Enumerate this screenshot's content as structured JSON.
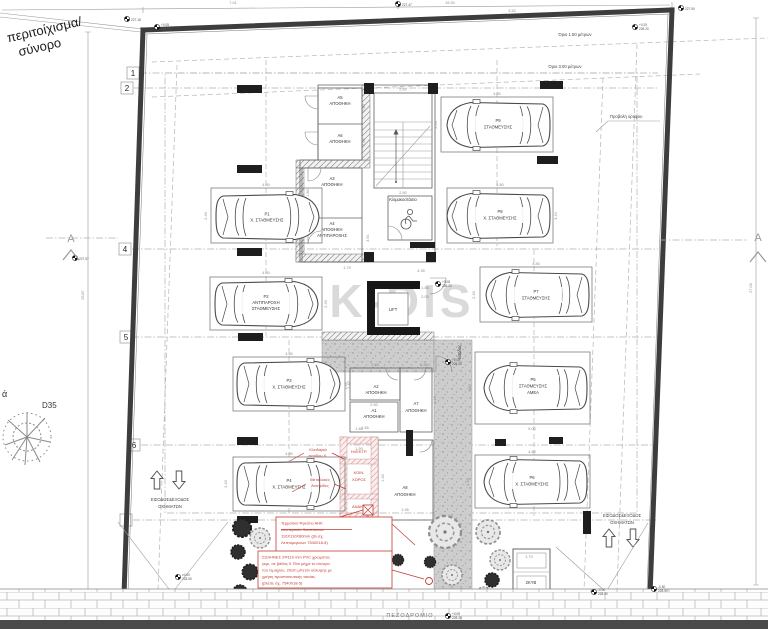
{
  "site": {
    "boundary_label": [
      "περιτοίχισμα/",
      "σύνορο"
    ],
    "tree_tag": "ά",
    "tree_id": "D35",
    "sidewalk": "ΠΕΖΟΔΡΟΜΙΟ",
    "setback_150": "Όριο 1.50 μέτρων",
    "setback_300": "Όριο 3.00 μέτρων",
    "projection": "Προβολή ορόφου",
    "entry_left": [
      "ΕΙΣΟΔΟΣ&ΕΞΟΔΟΣ",
      "ΟΧΗΜΑΤΩΝ"
    ],
    "entry_right": [
      "ΕΙΣΟΔΟΣ&ΕΞΟΔΟΣ",
      "ΟΧΗΜΑΤΩΝ"
    ],
    "section": "A",
    "watermark": "K-DIS",
    "bins": "2ΚΥΒ"
  },
  "grid": [
    "1",
    "2",
    "4",
    "5",
    "6",
    "7"
  ],
  "core": {
    "stair": "Κλιμακοστάσιο",
    "lift": "LIFT",
    "entrance": "είσοδος"
  },
  "storage": {
    "a1": [
      "A1",
      "ΑΠΟΘΗΚΗ"
    ],
    "a2": [
      "A2",
      "ΑΠΟΘΗΚΗ"
    ],
    "a3": [
      "A3",
      "ΑΠΟΘΗΚΗ"
    ],
    "a4": [
      "A4",
      "ΑΠΟΘΗΚΗ",
      "ΑΝΤΙΠΑΡΟΧΗΣ"
    ],
    "a5": [
      "A5",
      "ΑΠΟΘΗΚΗ"
    ],
    "a6": [
      "A6",
      "ΑΠΟΘΗΚΗ"
    ],
    "a7": [
      "A7",
      "ΑΠΟΘΗΚΗ"
    ],
    "a8": [
      "A8",
      "ΑΠΟΘΗΚΗ"
    ]
  },
  "parking": {
    "p1": [
      "P1",
      "Χ. ΣΤΑΘΜΕΥΣΗΣ"
    ],
    "p2": [
      "P2",
      "ΑΝΤΙΠΑΡΟΧΗ",
      "ΣΤΑΘΜΕΥΣΗΣ"
    ],
    "p3": [
      "P3",
      "Χ. ΣΤΑΘΜΕΥΣΗΣ"
    ],
    "p4": [
      "P4",
      "Χ. ΣΤΑΘΜΕΥΣΗΣ"
    ],
    "p5": [
      "P5",
      "ΣΤΑΘΜΕΥΣΗΣ",
      "ΑΜΕΑ"
    ],
    "p6": [
      "P6",
      "Χ. ΣΤΑΘΜΕΥΣΗΣ"
    ],
    "p7": [
      "P7",
      "ΣΤΑΘΜΕΥΣΗΣ"
    ],
    "p8": [
      "P8",
      "Χ. ΣΤΑΘΜΕΥΣΗΣ"
    ],
    "p9": [
      "P9",
      "ΣΤΑΘΜΕΥΣΗΣ"
    ]
  },
  "rooms": {
    "elec": "ΗΛΕΚΤΡ.",
    "common": [
      "ΚΟΙΝ.",
      "ΧΩΡΟΣ"
    ],
    "recycle": "ΑΝΑΚ."
  },
  "notes": {
    "lock": [
      "Κλειδαριά",
      "εισόδου Χ."
    ],
    "metal": [
      "Μεταλλικές",
      "Αντηρίδες"
    ],
    "ahk": [
      "Τερματικό Φρεάτιο ΑΗΚ",
      "εσωτερικών διαστάσεων",
      "110Χ110Χ80mm (βλ.σχ.",
      "Λεπτομερειών 7540018-5)"
    ],
    "pvc": [
      "ΣΩΛΗΝΕΣ 2Φ110 mm PVC χρώματος",
      "γκρι, σε βάθος 0.75m μέχρι το σύνορο",
      "του τεμαχίου, 20cm μπετόν κάλυψης με",
      "χρήση προστατευτικής ταινίας.",
      "(βλέπε σχ. 7540018-5)"
    ]
  },
  "dims": {
    "d480": "4.80",
    "d240": "2.40",
    "d344": "3.44",
    "d330": "3.30",
    "d500": "5.00",
    "d170": "1.70",
    "d280": "2.80",
    "d164": "1.64",
    "d180": "1.80",
    "d179": "1.79",
    "d391": "3.91",
    "d435": "4.35",
    "d185": "1.85",
    "d205": "2.05",
    "d245": "2.45",
    "d158": "1.58",
    "d133": "1.33",
    "d250": "2.50",
    "d310": "3.10",
    "d150": "1.50",
    "d140": "1.40",
    "d195": "1.95",
    "d1630": "16.30",
    "d701": "7.01",
    "d352": "3.52",
    "d2587": "25.87",
    "d2703": "27.03"
  },
  "levels": {
    "m22718": "227.18",
    "m22747": "227.47",
    "m22750": "227.50",
    "m22757": "227.57",
    "p005": "+0.05",
    "e22820": "228.20",
    "p020": "+0.20",
    "e22830": "228.30",
    "n050": "-0.50",
    "e22850": "228.50",
    "z000": "±0.00"
  }
}
